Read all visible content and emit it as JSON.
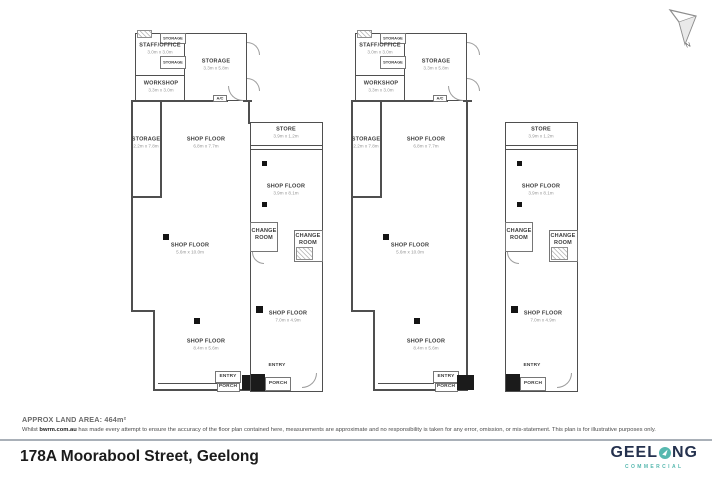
{
  "meta": {
    "land_area_label": "APPROX LAND AREA: 464m²",
    "disclaimer_prefix": "Whilst ",
    "disclaimer_bold": "bwrm.com.au",
    "disclaimer_rest": " has made every attempt to ensure the accuracy of the floor plan contained here, measurements are approximate and no responsibility is taken for any error, omission, or mis-statement. This plan is for illustrative purposes only.",
    "address": "178A Moorabool Street, Geelong",
    "compass_label": "N"
  },
  "logo": {
    "part1": "GEEL",
    "part2": "NG",
    "subtitle": "COMMERCIAL",
    "navy": "#24314e",
    "teal": "#57b8af"
  },
  "rooms": {
    "storage_top": {
      "label": "STORAGE"
    },
    "storage_small": {
      "label": "STORAGE"
    },
    "staff_office": {
      "label": "STAFF/OFFICE",
      "dims": "3.0m x 3.0m"
    },
    "workshop": {
      "label": "WORKSHOP",
      "dims": "3.3m x 3.0m"
    },
    "storage_large": {
      "label": "STORAGE",
      "dims": "3.3m x 5.8m"
    },
    "storage_narrow": {
      "label": "STORAGE",
      "dims": "2.2m x 7.8m"
    },
    "shop_floor_upper": {
      "label": "SHOP FLOOR",
      "dims": "6.8m x 7.7m"
    },
    "store": {
      "label": "STORE",
      "dims": "3.9m x 1.2m"
    },
    "shop_floor_strip": {
      "label": "SHOP FLOOR",
      "dims": "3.9m x 8.1m"
    },
    "change_room": {
      "label": "CHANGE ROOM"
    },
    "shop_floor_main": {
      "label": "SHOP FLOOR",
      "dims": "5.6m x 10.0m"
    },
    "shop_floor_lower": {
      "label": "SHOP FLOOR",
      "dims": "8.4m x 5.6m"
    },
    "shop_floor_strip_low": {
      "label": "SHOP FLOOR",
      "dims": "7.0m x 4.9m"
    },
    "entry": {
      "label": "ENTRY"
    },
    "porch": {
      "label": "PORCH"
    },
    "ac": {
      "label": "A/C"
    }
  }
}
